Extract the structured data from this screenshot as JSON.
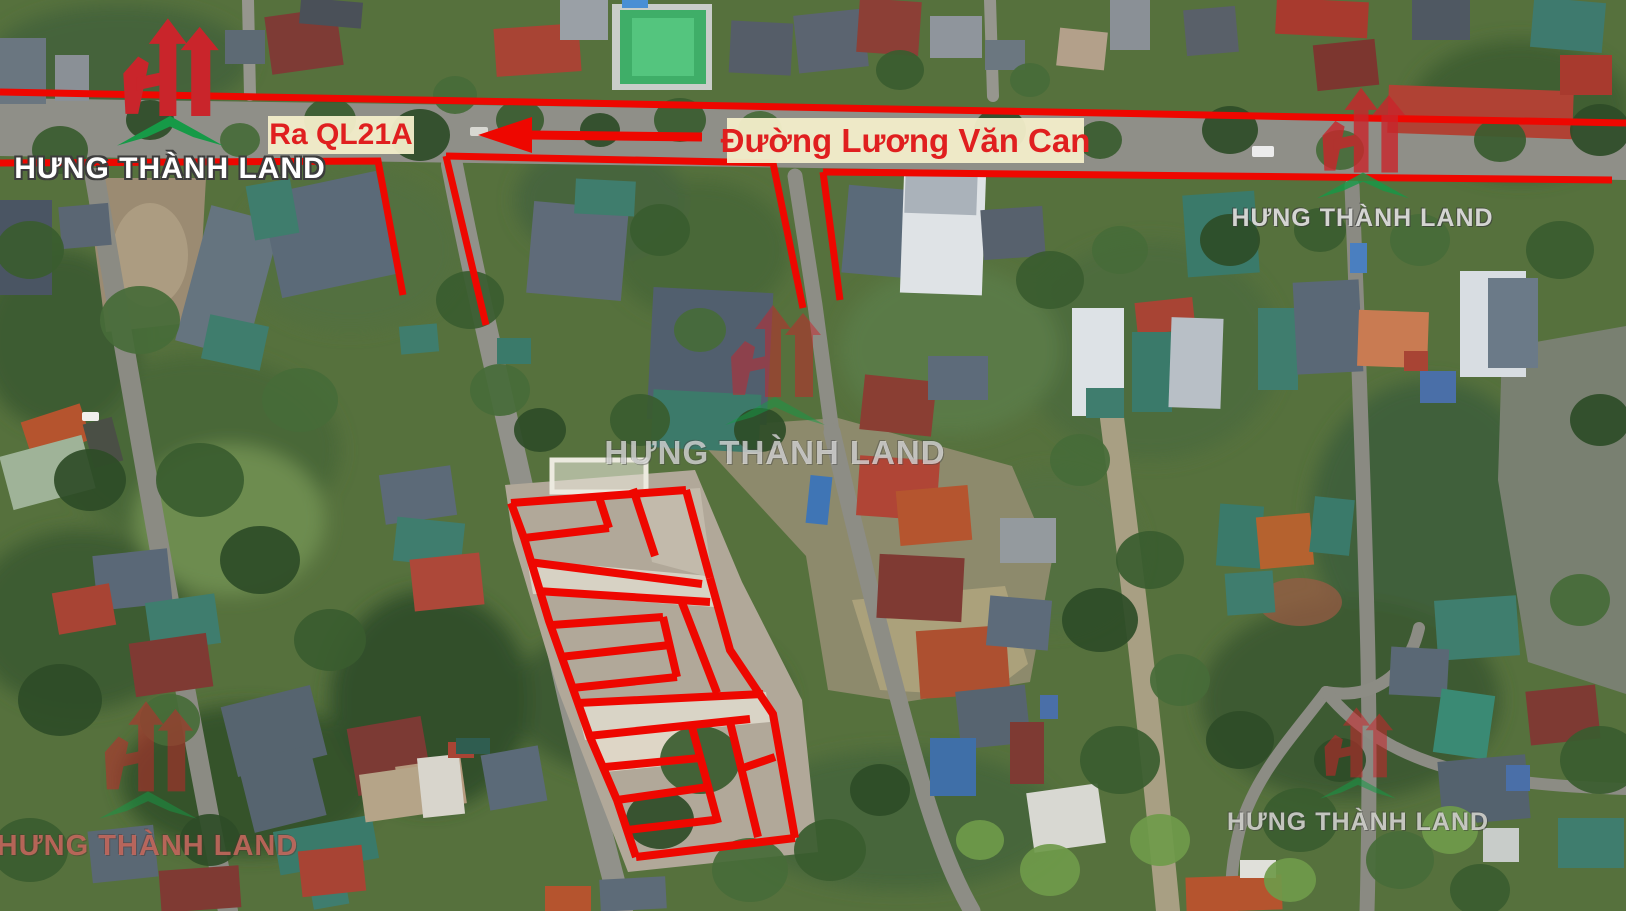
{
  "brand": {
    "name": "HƯNG THÀNH LAND"
  },
  "labels": {
    "street_name": "Đường Lương Văn Can",
    "direction": "Ra QL21A"
  },
  "colors": {
    "annotation_red": "#ee0700",
    "label_background": "#f3eeca",
    "label_text": "#e01f1f",
    "logo_red": "#c9252b",
    "logo_green": "#169a47"
  },
  "watermarks": [
    "top-left",
    "top-right",
    "center",
    "bottom-left",
    "bottom-right"
  ],
  "overlay": {
    "color": "#ee0700",
    "road_lines": [
      {
        "points": [
          [
            0,
            92
          ],
          [
            1626,
            123
          ]
        ],
        "w": 7
      },
      {
        "points": [
          [
            0,
            163
          ],
          [
            378,
            161
          ],
          [
            403,
            295
          ]
        ],
        "w": 7
      },
      {
        "points": [
          [
            446,
            156
          ],
          [
            486,
            325
          ]
        ],
        "w": 7
      },
      {
        "points": [
          [
            446,
            156
          ],
          [
            773,
            163
          ],
          [
            803,
            308
          ]
        ],
        "w": 7
      },
      {
        "points": [
          [
            823,
            172
          ],
          [
            840,
            300
          ]
        ],
        "w": 7
      },
      {
        "points": [
          [
            823,
            172
          ],
          [
            1612,
            180
          ]
        ],
        "w": 7
      }
    ],
    "plot_lines": [
      {
        "points": [
          [
            511,
            503
          ],
          [
            686,
            490
          ]
        ]
      },
      {
        "points": [
          [
            511,
            503
          ],
          [
            524,
            538
          ],
          [
            549,
            621
          ],
          [
            590,
            737
          ],
          [
            617,
            800
          ],
          [
            636,
            857
          ]
        ]
      },
      {
        "points": [
          [
            686,
            490
          ],
          [
            710,
            578
          ]
        ]
      },
      {
        "points": [
          [
            710,
            578
          ],
          [
            730,
            650
          ],
          [
            773,
            714
          ],
          [
            795,
            838
          ]
        ]
      },
      {
        "points": [
          [
            636,
            857
          ],
          [
            795,
            838
          ]
        ]
      },
      {
        "points": [
          [
            524,
            538
          ],
          [
            609,
            528
          ]
        ]
      },
      {
        "points": [
          [
            598,
            494
          ],
          [
            609,
            528
          ]
        ]
      },
      {
        "points": [
          [
            633,
            489
          ],
          [
            655,
            556
          ]
        ]
      },
      {
        "points": [
          [
            529,
            562
          ],
          [
            702,
            584
          ]
        ]
      },
      {
        "points": [
          [
            537,
            591
          ],
          [
            710,
            602
          ]
        ]
      },
      {
        "points": [
          [
            552,
            625
          ],
          [
            663,
            617
          ]
        ]
      },
      {
        "points": [
          [
            560,
            657
          ],
          [
            670,
            645
          ]
        ]
      },
      {
        "points": [
          [
            572,
            688
          ],
          [
            677,
            677
          ]
        ]
      },
      {
        "points": [
          [
            663,
            617
          ],
          [
            677,
            677
          ]
        ]
      },
      {
        "points": [
          [
            681,
            600
          ],
          [
            717,
            693
          ]
        ]
      },
      {
        "points": [
          [
            578,
            703
          ],
          [
            763,
            694
          ]
        ]
      },
      {
        "points": [
          [
            588,
            736
          ],
          [
            750,
            719
          ]
        ]
      },
      {
        "points": [
          [
            692,
            727
          ],
          [
            718,
            823
          ]
        ]
      },
      {
        "points": [
          [
            605,
            767
          ],
          [
            700,
            758
          ]
        ]
      },
      {
        "points": [
          [
            617,
            800
          ],
          [
            708,
            787
          ]
        ]
      },
      {
        "points": [
          [
            627,
            830
          ],
          [
            714,
            820
          ]
        ]
      },
      {
        "points": [
          [
            730,
            722
          ],
          [
            758,
            837
          ]
        ]
      },
      {
        "points": [
          [
            743,
            768
          ],
          [
            775,
            757
          ]
        ]
      }
    ],
    "arrow": {
      "tail": [
        [
          702,
          137
        ],
        [
          530,
          135
        ]
      ],
      "head": [
        [
          478,
          135
        ],
        [
          532,
          117
        ],
        [
          532,
          153
        ]
      ],
      "w": 9
    }
  }
}
